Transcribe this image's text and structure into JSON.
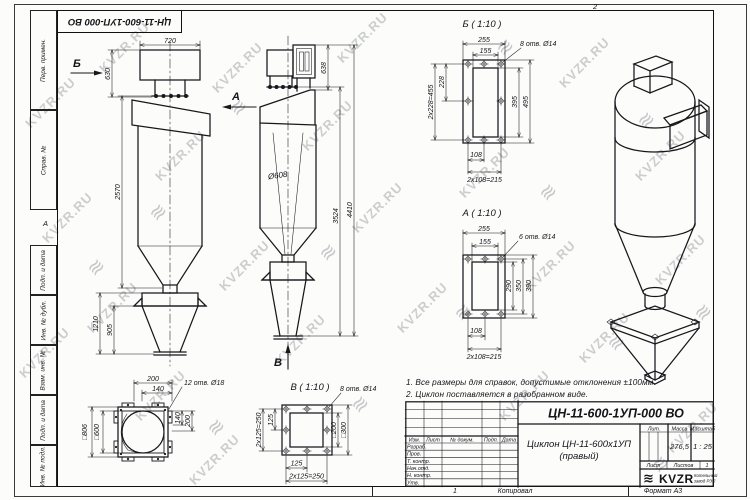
{
  "watermark": {
    "text": "KVZR.RU",
    "stripes_glyph": "≋"
  },
  "frame": {
    "top_stamp": "ЦН-11-600-1УП-000 ВО",
    "fold_mark_top": "2",
    "fold_mark_left": "А",
    "left_labels": [
      "Перв. примен.",
      "Справ. №",
      "Подп. и дата",
      "Инв. № дубл.",
      "Взам. инв. №",
      "Подп. и дата",
      "Инв. № подл."
    ]
  },
  "views": {
    "side": {
      "arrow_b": "Б",
      "arrow_a": "А",
      "dim_720": "720",
      "dim_630": "630",
      "dim_2570": "2570",
      "dim_1210": "1210",
      "dim_905": "905"
    },
    "front": {
      "dim_638": "638",
      "dia_608": "Ø608",
      "dim_3524": "3524",
      "dim_4410": "4410",
      "arrow_v": "В"
    },
    "section_b": {
      "title": "Б ( 1:10 )",
      "holes": "8 отв. Ø14",
      "d255": "255",
      "d155": "155",
      "d228": "228",
      "d455": "2x228=455",
      "d395": "395",
      "d495": "495",
      "d108": "108",
      "d215": "2x108=215"
    },
    "section_a": {
      "title": "А ( 1:10 )",
      "holes": "6 отв. Ø14",
      "d255": "255",
      "d155": "155",
      "d290": "290",
      "d350": "350",
      "d390": "390",
      "d108": "108",
      "d215": "2x108=215"
    },
    "top": {
      "holes": "12 отв. Ø18",
      "d200_top": "200",
      "d140_top": "140",
      "d140_r": "140",
      "d200_r": "200",
      "sq806": "□806",
      "sq600": "□600"
    },
    "section_v": {
      "title": "В ( 1:10 )",
      "holes": "8 отв. Ø14",
      "d125_l": "125",
      "d250_l": "2x125=250",
      "sq200": "□200",
      "sq300": "□300",
      "d125_b": "125",
      "d250_b": "2x125=250"
    }
  },
  "notes": {
    "line1": "1. Все размеры для справок, допустимые отклонения ±100мм.",
    "line2": "2. Циклон поставляется в разобранном виде."
  },
  "title_block": {
    "doc_number": "ЦН-11-600-1УП-000 ВО",
    "product_name_line1": "Циклон ЦН-11-600х1УП",
    "product_name_line2": "(правый)",
    "col_izm": "Изм.",
    "col_list": "Лист",
    "col_doc": "№ докум.",
    "col_podp": "Подп.",
    "col_data": "Дата",
    "row_razrab": "Разраб.",
    "row_prov": "Пров.",
    "row_tkontr": "Т. контр.",
    "row_nachotd": "Нач.отд.",
    "row_nkontr": "Н. контр.",
    "row_utv": "Утв.",
    "lit_label": "Лит.",
    "mass_label": "Масса",
    "scale_label": "Масштаб",
    "mass_value": "276,5",
    "scale_value": "1 : 25",
    "sheet_label": "Лист",
    "sheets_label": "Листов",
    "sheets_value": "1",
    "logo_text": "KVZR",
    "logo_sub1": "Котельный",
    "logo_sub2": "завод РЭП",
    "footer_num": "1",
    "footer_copy": "Копировал",
    "footer_format": "Формат А3"
  }
}
